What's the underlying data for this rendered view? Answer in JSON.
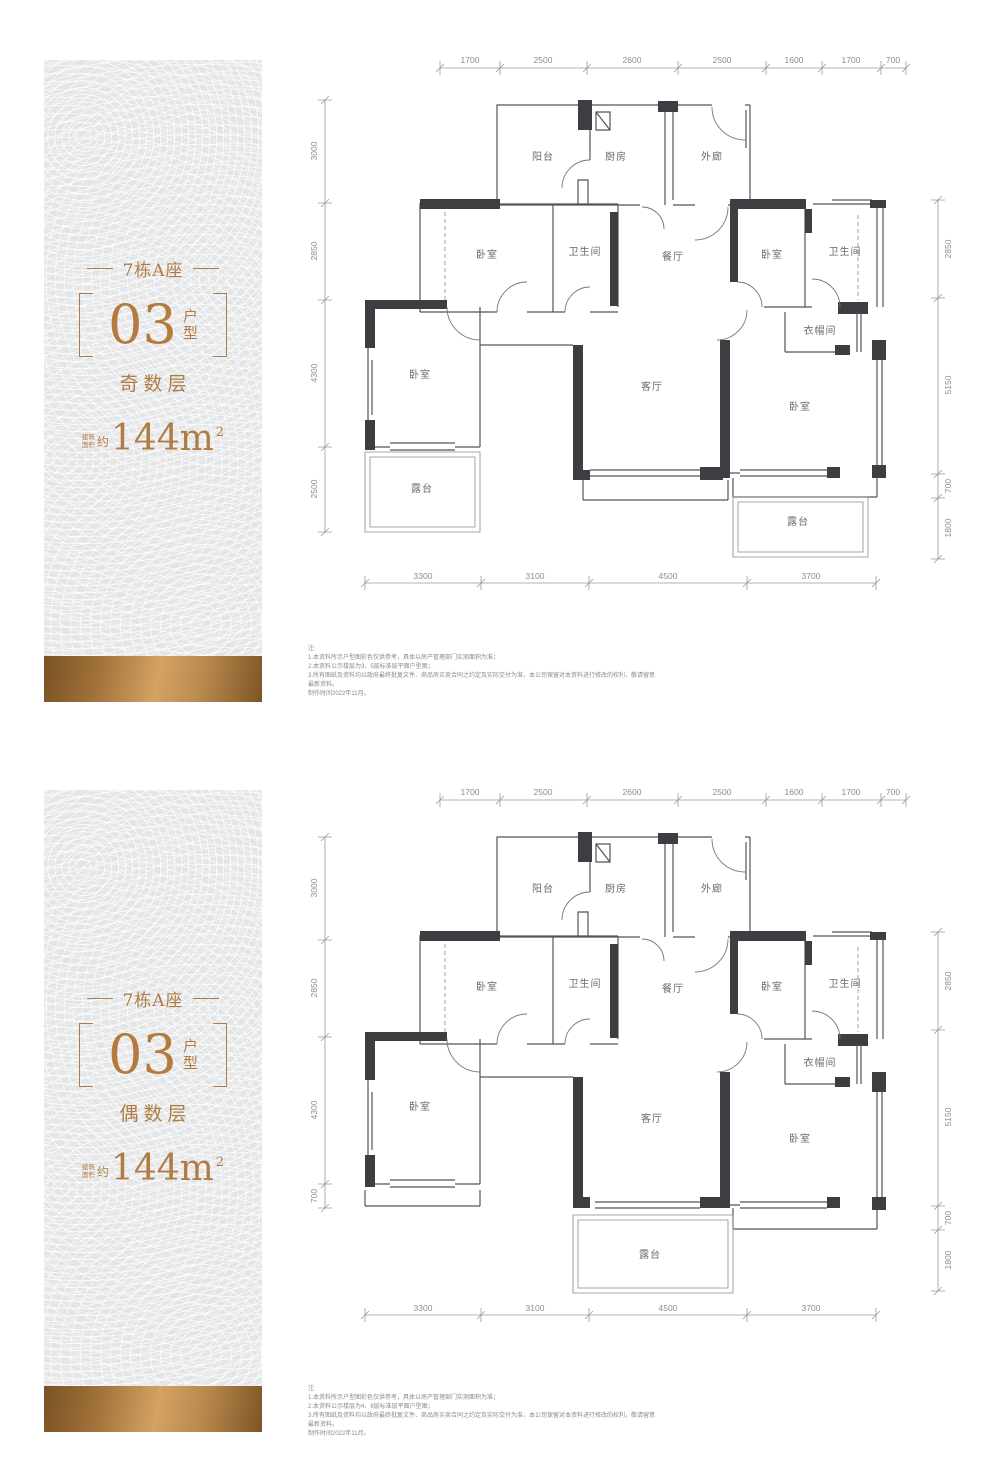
{
  "panels": [
    {
      "sidebar": {
        "building": "7栋A座",
        "unit_number": "03",
        "unit_char_1": "户",
        "unit_char_2": "型",
        "floor_type": "奇数层",
        "area_small_1": "建筑",
        "area_small_2": "面积",
        "area_approx": "约",
        "area_value": "144m",
        "area_sup": "2"
      },
      "plan": {
        "dims_top": [
          "1700",
          "2500",
          "2600",
          "2500",
          "1600",
          "1700",
          "700"
        ],
        "dims_bottom": [
          "3300",
          "3100",
          "4500",
          "3700"
        ],
        "dims_left": [
          "3000",
          "2850",
          "4300",
          "2500"
        ],
        "dims_right": [
          "2850",
          "5150",
          "700",
          "1800"
        ],
        "rooms": {
          "balcony": "阳台",
          "kitchen": "厨房",
          "corridor": "外廊",
          "bedroom_a": "卧室",
          "bath_a": "卫生间",
          "dining": "餐厅",
          "bedroom_b": "卧室",
          "bath_b": "卫生间",
          "bedroom_c": "卧室",
          "living": "客厅",
          "cloakroom": "衣帽间",
          "bedroom_d": "卧室",
          "terrace_left": "露台",
          "terrace_right": "露台"
        }
      },
      "notes": {
        "title": "注:",
        "line1": "1.本资料所示户型图彩色仅供参考，具体以房产管理部门实测面积为准；",
        "line2": "2.本资料公示楼层为3、5层标准层平面户型图；",
        "line3": "3.所有图纸及资料均以政府最终批复文件、商品房买卖合同之约定及实际交付为准，本公司保留对本资料进行修改的权利，敬请留意最新资料。",
        "line4": "制作时间2022年11月。"
      }
    },
    {
      "sidebar": {
        "building": "7栋A座",
        "unit_number": "03",
        "unit_char_1": "户",
        "unit_char_2": "型",
        "floor_type": "偶数层",
        "area_small_1": "建筑",
        "area_small_2": "面积",
        "area_approx": "约",
        "area_value": "144m",
        "area_sup": "2"
      },
      "plan": {
        "dims_top": [
          "1700",
          "2500",
          "2600",
          "2500",
          "1600",
          "1700",
          "700"
        ],
        "dims_bottom": [
          "3300",
          "3100",
          "4500",
          "3700"
        ],
        "dims_left": [
          "3000",
          "2850",
          "4300",
          "700"
        ],
        "dims_right": [
          "2850",
          "5150",
          "700",
          "1800"
        ],
        "rooms": {
          "balcony": "阳台",
          "kitchen": "厨房",
          "corridor": "外廊",
          "bedroom_a": "卧室",
          "bath_a": "卫生间",
          "dining": "餐厅",
          "bedroom_b": "卧室",
          "bath_b": "卫生间",
          "bedroom_c": "卧室",
          "living": "客厅",
          "cloakroom": "衣帽间",
          "bedroom_d": "卧室",
          "terrace": "露台"
        }
      },
      "notes": {
        "title": "注:",
        "line1": "1.本资料所示户型图彩色仅供参考，具体以房产管理部门实测面积为准；",
        "line2": "2.本资料公示楼层为4、6层标准层平面户型图；",
        "line3": "3.所有图纸及资料均以政府最终批复文件、商品房买卖合同之约定及实际交付为准，本公司保留对本资料进行修改的权利，敬请留意最新资料。",
        "line4": "制作时间2022年11月。"
      }
    }
  ]
}
